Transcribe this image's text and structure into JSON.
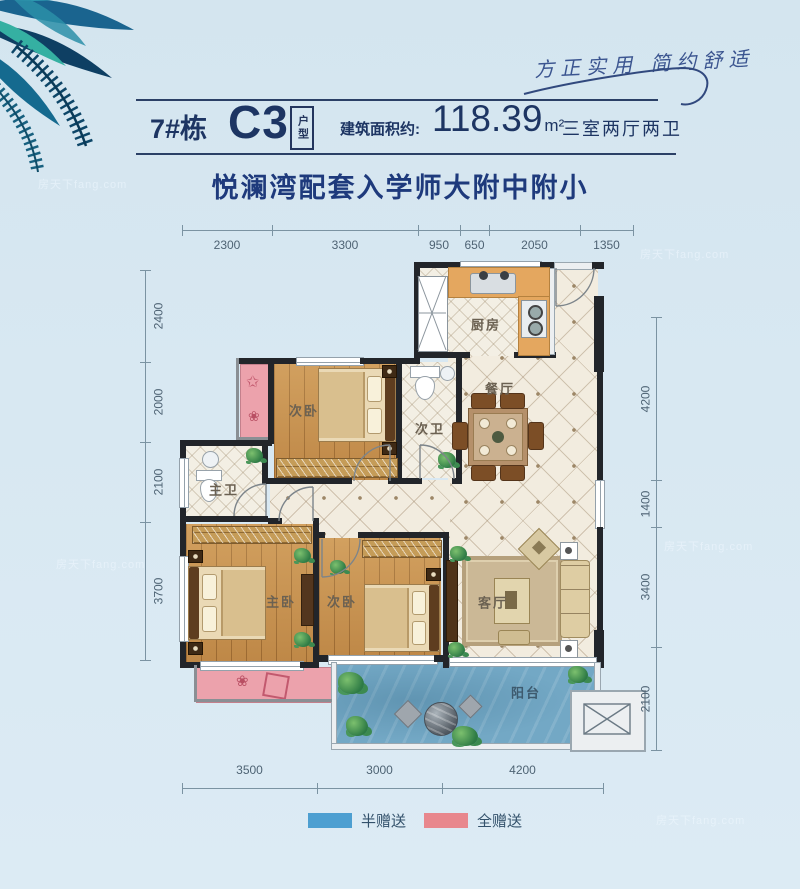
{
  "page": {
    "watermark": "房天下fang.com",
    "calligraphy": "方正实用 简约舒适"
  },
  "header": {
    "building": "7#栋",
    "unit_code": "C3",
    "unit_type_label": "户型",
    "area_label": "建筑面积约:",
    "area_value": "118.39",
    "area_unit": "m²",
    "room_layout": "三室两厅两卫"
  },
  "subtitle": "悦澜湾配套入学师大附中附小",
  "floorplan": {
    "rooms": {
      "kitchen": "厨房",
      "dining": "餐厅",
      "bedroom_top": "次卧",
      "bath_second": "次卫",
      "bath_master": "主卫",
      "bedroom_master": "主卧",
      "bedroom_second": "次卧",
      "living": "客厅",
      "balcony": "阳台"
    },
    "dimensions": {
      "top": [
        "2300",
        "3300",
        "950",
        "650",
        "2050",
        "1350"
      ],
      "left": [
        "2400",
        "2000",
        "2100",
        "3700"
      ],
      "right": [
        "4200",
        "1400",
        "3400",
        "2100"
      ],
      "bottom": [
        "3500",
        "3000",
        "4200"
      ]
    }
  },
  "legend": {
    "items": [
      {
        "label": "半赠送",
        "color": "#4d9fd1"
      },
      {
        "label": "全赠送",
        "color": "#e8878d"
      }
    ]
  }
}
